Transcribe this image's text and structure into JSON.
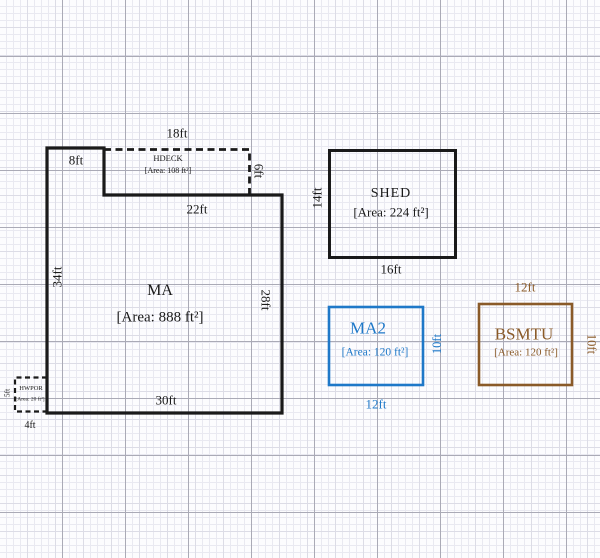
{
  "colors": {
    "black": "#1a1a1a",
    "blue": "#1E78C8",
    "brown": "#8A5A28",
    "grid_minor": "#e9e9f1",
    "grid_major": "#aaaab6",
    "background": "#fcfcfe"
  },
  "buildings": {
    "ma": {
      "name": "MA",
      "area": "[Area: 888 ft²]",
      "dim_top_left": "8ft",
      "dim_notch_bottom": "22ft",
      "dim_left": "34ft",
      "dim_right": "28ft",
      "dim_bottom": "30ft"
    },
    "hdeck": {
      "name": "HDECK",
      "area": "[Area: 108 ft²]",
      "dim_top": "18ft",
      "dim_right": "6ft"
    },
    "hwpor": {
      "name": "HWPOR",
      "area": "[Area: 20 ft²]",
      "dim_left": "5ft",
      "dim_bottom": "4ft"
    },
    "shed": {
      "name": "SHED",
      "area": "[Area: 224 ft²]",
      "dim_left": "14ft",
      "dim_bottom": "16ft"
    },
    "ma2": {
      "name": "MA2",
      "area": "[Area: 120 ft²]",
      "dim_right": "10ft",
      "dim_bottom": "12ft"
    },
    "bsmtu": {
      "name": "BSMTU",
      "area": "[Area: 120 ft²]",
      "dim_right": "10ft",
      "dim_top": "12ft"
    }
  }
}
